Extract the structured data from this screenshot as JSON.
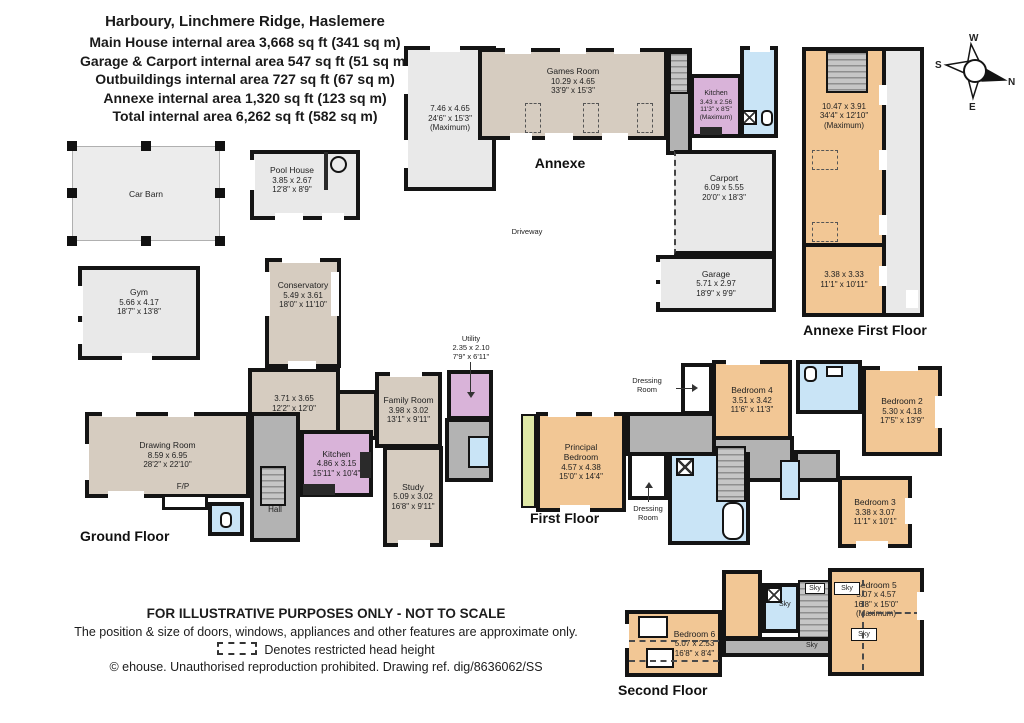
{
  "header": {
    "address": "Harboury, Linchmere Ridge, Haslemere",
    "area_lines": [
      "Main House internal area 3,668 sq ft (341 sq m)",
      "Garage & Carport internal area 547 sq ft (51 sq m)",
      "Outbuildings internal area 727 sq ft (67 sq m)",
      "Annexe internal area 1,320 sq ft (123 sq m)",
      "Total internal area 6,262 sq ft (582 sq m)"
    ]
  },
  "compass": {
    "north": "N",
    "south": "S",
    "east": "E",
    "west": "W"
  },
  "floor_labels": {
    "annexe": "Annexe",
    "annexe_first": "Annexe First Floor",
    "ground": "Ground Floor",
    "first": "First Floor",
    "second": "Second Floor"
  },
  "site_labels": {
    "driveway": "Driveway",
    "fireplace": "F/P",
    "hall": "Hall",
    "sky": "Sky"
  },
  "rooms": {
    "car_barn": {
      "name": "Car Barn"
    },
    "pool_house": {
      "name": "Pool House",
      "metric": "3.85 x 2.67",
      "imperial": "12'8\" x 8'9\""
    },
    "gym": {
      "name": "Gym",
      "metric": "5.66 x 4.17",
      "imperial": "18'7\" x 13'8\""
    },
    "annexe_room": {
      "metric": "7.46 x 4.65",
      "imperial": "24'6\" x 15'3\"",
      "note": "(Maximum)"
    },
    "games_room": {
      "name": "Games Room",
      "metric": "10.29 x 4.65",
      "imperial": "33'9\" x 15'3\""
    },
    "annexe_kitchen": {
      "name": "Kitchen",
      "metric": "3.43 x 2.56",
      "imperial": "11'3\" x 8'5\"",
      "note": "(Maximum)"
    },
    "carport": {
      "name": "Carport",
      "metric": "6.09 x 5.55",
      "imperial": "20'0\" x 18'3\""
    },
    "garage": {
      "name": "Garage",
      "metric": "5.71 x 2.97",
      "imperial": "18'9\" x 9'9\""
    },
    "annexe_ff_main": {
      "metric": "10.47 x 3.91",
      "imperial": "34'4\" x 12'10\"",
      "note": "(Maximum)"
    },
    "annexe_ff_second": {
      "metric": "3.38 x 3.33",
      "imperial": "11'1\" x 10'11\""
    },
    "conservatory": {
      "name": "Conservatory",
      "metric": "5.49 x 3.61",
      "imperial": "18'0\" x 11'10\""
    },
    "sitting_room": {
      "metric": "3.71 x 3.65",
      "imperial": "12'2\" x 12'0\""
    },
    "family_room": {
      "name": "Family Room",
      "metric": "3.98 x 3.02",
      "imperial": "13'1\" x 9'11\""
    },
    "utility": {
      "name": "Utility",
      "metric": "2.35 x 2.10",
      "imperial": "7'9\" x 6'11\""
    },
    "drawing_room": {
      "name": "Drawing Room",
      "metric": "8.59 x 6.95",
      "imperial": "28'2\" x 22'10\""
    },
    "kitchen": {
      "name": "Kitchen",
      "metric": "4.86 x 3.15",
      "imperial": "15'11\" x 10'4\""
    },
    "study": {
      "name": "Study",
      "metric": "5.09 x 3.02",
      "imperial": "16'8\" x 9'11\""
    },
    "principal_bedroom": {
      "name1": "Principal",
      "name2": "Bedroom",
      "metric": "4.57 x 4.38",
      "imperial": "15'0\" x 14'4\""
    },
    "dressing_room": {
      "name1": "Dressing",
      "name2": "Room"
    },
    "bedroom_2": {
      "name": "Bedroom 2",
      "metric": "5.30 x 4.18",
      "imperial": "17'5\" x 13'9\""
    },
    "bedroom_3": {
      "name": "Bedroom 3",
      "metric": "3.38 x 3.07",
      "imperial": "11'1\" x 10'1\""
    },
    "bedroom_4": {
      "name": "Bedroom 4",
      "metric": "3.51 x 3.42",
      "imperial": "11'6\" x 11'3\""
    },
    "bedroom_5": {
      "name": "Bedroom 5",
      "metric": "5.07 x 4.57",
      "imperial": "16'8\" x 15'0\"",
      "note": "(Maximum)"
    },
    "bedroom_6": {
      "name": "Bedroom 6",
      "metric": "5.07 x 2.53",
      "imperial": "16'8\" x 8'4\""
    }
  },
  "footer": {
    "line1": "FOR ILLUSTRATIVE PURPOSES ONLY - NOT TO SCALE",
    "line2": "The position & size of doors, windows, appliances and other features are approximate only.",
    "line3": "Denotes restricted head height",
    "line4": "© ehouse. Unauthorised reproduction prohibited. Drawing ref. dig/8636062/SS"
  },
  "colors": {
    "wall": "#141414",
    "room_tan": "#d6ccc0",
    "room_peach": "#f2c795",
    "room_purple": "#d9b3d9",
    "room_blue": "#c9e4f6",
    "room_gray_light": "#e9e9e9",
    "circulation_gray": "#b3b3b3",
    "balcony_green": "#dfe8a7"
  }
}
